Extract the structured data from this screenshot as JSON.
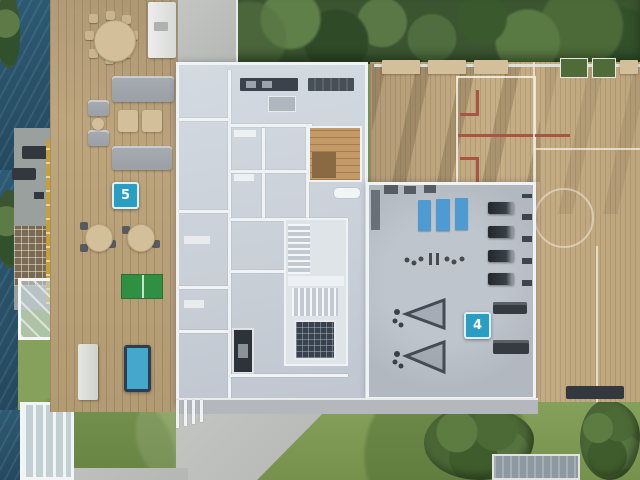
{
  "scene": {
    "markers": [
      {
        "label": "5"
      },
      {
        "label": "4"
      }
    ],
    "colors": {
      "marker_blue": "#2a9ec2",
      "water": "#2d5a74",
      "deck_wood": "#c2aa82",
      "court_wood": "#c6ae86",
      "court_line": "#efe9da",
      "red_line": "#a85545",
      "gym_floor": "#b2b8c0",
      "building_floor": "#c9d0d8",
      "wall_white": "#f0f3f5",
      "grass": "#86a15b",
      "tree_green": "#3b5530",
      "bush_green": "#4a6635",
      "pingpong_green": "#2f8f42",
      "pooltable_blue": "#43a8cc",
      "mat_blue": "#4d9bd1",
      "canopy_yellow": "#c3a138",
      "path_gray": "#c3c6c2",
      "sauna_wood": "#c49a66",
      "dark_equipment": "#33383f",
      "furniture_gray": "#9aa0a6",
      "cushion_beige": "#d4bf9b"
    }
  }
}
